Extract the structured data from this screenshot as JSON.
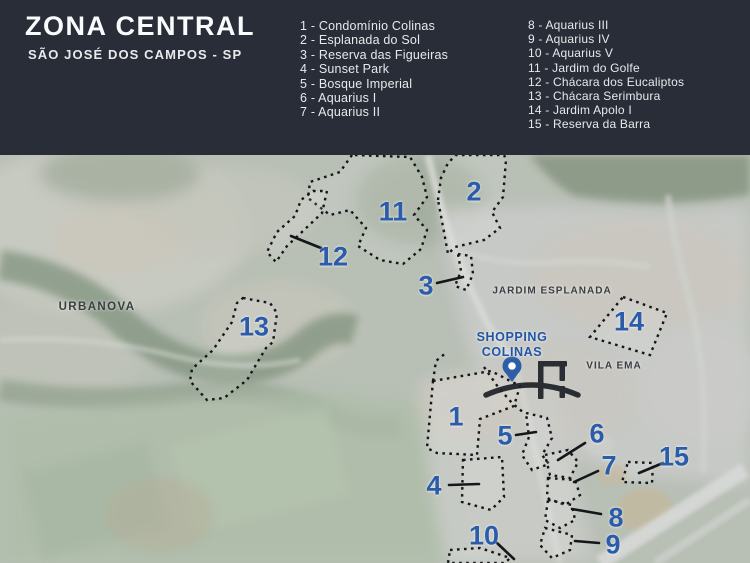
{
  "header": {
    "title": "ZONA CENTRAL",
    "subtitle": "SÃO JOSÉ DOS CAMPOS - SP",
    "legend": {
      "col1": [
        "1 - Condomínio Colinas",
        "2 - Esplanada do Sol",
        "3 - Reserva das Figueiras",
        "4 - Sunset Park",
        "5 - Bosque Imperial",
        "6 - Aquarius I",
        "7 - Aquarius II"
      ],
      "col2": [
        "8 - Aquarius III",
        "9 - Aquarius IV",
        "10 - Aquarius V",
        "11 - Jardim do Golfe",
        "12 - Chácara dos Eucaliptos",
        "13 - Chácara Serimbura",
        "14 - Jardim Apolo I",
        "15 - Reserva da Barra"
      ]
    }
  },
  "map": {
    "area_labels": {
      "urbanova": "URBANOVA",
      "jardim_esplanada": "JARDIM ESPLANADA",
      "vila_ema": "VILA EMA"
    },
    "shopping": {
      "line1": "SHOPPING",
      "line2": "COLINAS"
    },
    "markers": [
      {
        "num": "1"
      },
      {
        "num": "2"
      },
      {
        "num": "3"
      },
      {
        "num": "4"
      },
      {
        "num": "5"
      },
      {
        "num": "6"
      },
      {
        "num": "7"
      },
      {
        "num": "8"
      },
      {
        "num": "9"
      },
      {
        "num": "10"
      },
      {
        "num": "11"
      },
      {
        "num": "12"
      },
      {
        "num": "13"
      },
      {
        "num": "14"
      },
      {
        "num": "15"
      }
    ],
    "icons": {
      "pin": "location-pin",
      "logo": "arc-monogram-watermark"
    },
    "colors": {
      "header_bg": "#282d37",
      "marker_blue": "#2b5caa",
      "shopping_blue": "#2155a6",
      "area_label_gray": "#3a3d41",
      "outline_black": "#14161a"
    }
  }
}
